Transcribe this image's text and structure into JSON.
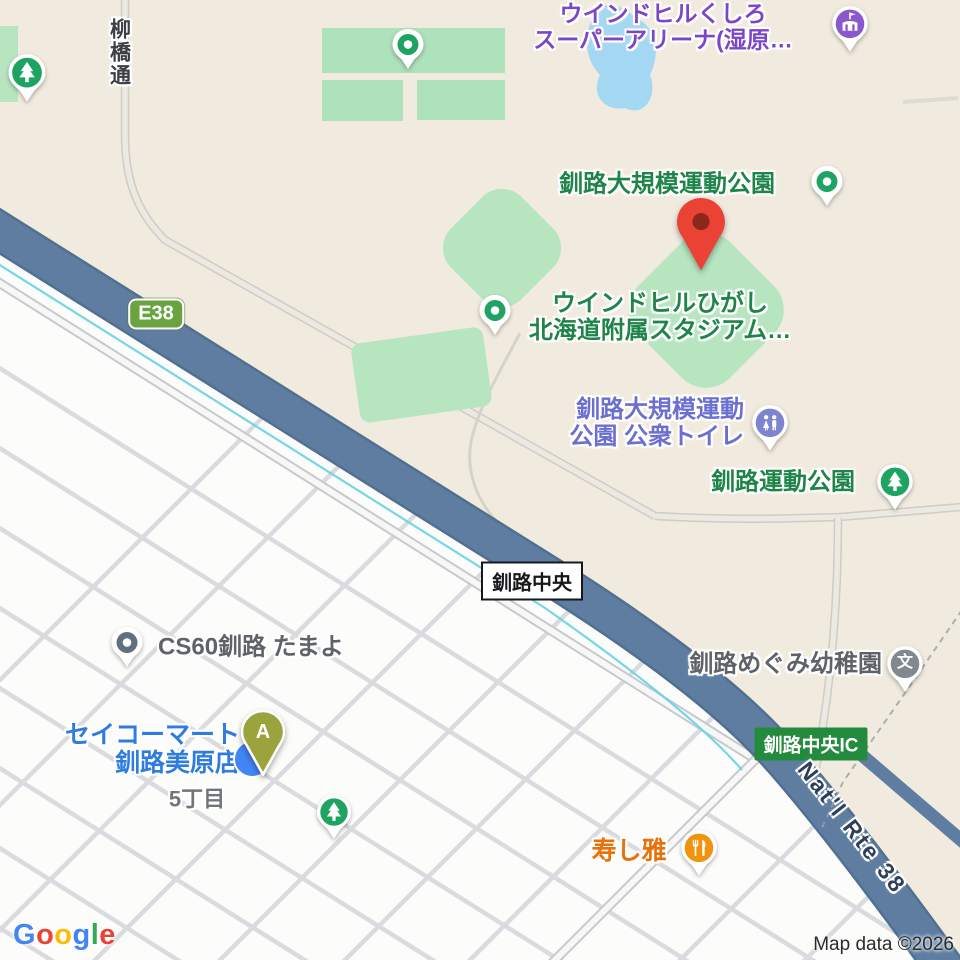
{
  "labels": {
    "arena": {
      "line1": "ウインドヒルくしろ",
      "line2": "スーパーアリーナ(湿原…"
    },
    "road_yanagibashi": "柳橋通",
    "park_main": "釧路大規模運動公園",
    "stadium": {
      "line1": "ウインドヒルひがし",
      "line2": "北海道附属スタジアム…"
    },
    "toilet": {
      "line1": "釧路大規模運動",
      "line2": "公園 公衆トイレ"
    },
    "park_undo": "釧路運動公園",
    "shield_e38": "E38",
    "junction": "釧路中央",
    "cs60": "CS60釧路 たまよ",
    "kindergarten": "釧路めぐみ幼稚園",
    "seicomart": {
      "line1": "セイコーマート",
      "line2": "釧路美原店"
    },
    "district_5chome": "5丁目",
    "sushi_masa": "寿し雅",
    "ic_badge": "釧路中央IC",
    "route38": "Nat'l Rte 38",
    "marker_a": "A",
    "school_glyph": "文",
    "attribution": "Map data ©2026"
  },
  "google_logo": [
    {
      "char": "G",
      "style": "color:#4285F4"
    },
    {
      "char": "o",
      "style": "color:#EA4335"
    },
    {
      "char": "o",
      "style": "color:#FBBC05"
    },
    {
      "char": "g",
      "style": "color:#4285F4"
    },
    {
      "char": "l",
      "style": "color:#34A853"
    },
    {
      "char": "e",
      "style": "color:#EA4335"
    }
  ],
  "colors": {
    "background_beige": "#f1ebdf",
    "urban_white": "#fcfcfb",
    "park_fill": "#b7e5c0",
    "water": "#a4d7f2",
    "expressway_blue": "#5e7da1",
    "stream_cyan": "#66d3e3",
    "park_label_green": "#1e8449",
    "arena_label_purple": "#7b46c8",
    "toilet_label_slate": "#6a6fd0",
    "store_label_blue": "#2e7cdf",
    "restaurant_label_orange": "#e8710a",
    "gray_label": "#5f6368",
    "shield_green": "#69a440",
    "ic_badge_green": "#248a3d",
    "destination_marker_red": "#EA4335",
    "marker_a_olive": "#9aa33c",
    "tree_pin_green": "#1ea362",
    "toilet_pin_periwinkle": "#7e84cf",
    "school_pin_gray": "#81888f",
    "arena_pin_purple": "#8a57cc"
  }
}
